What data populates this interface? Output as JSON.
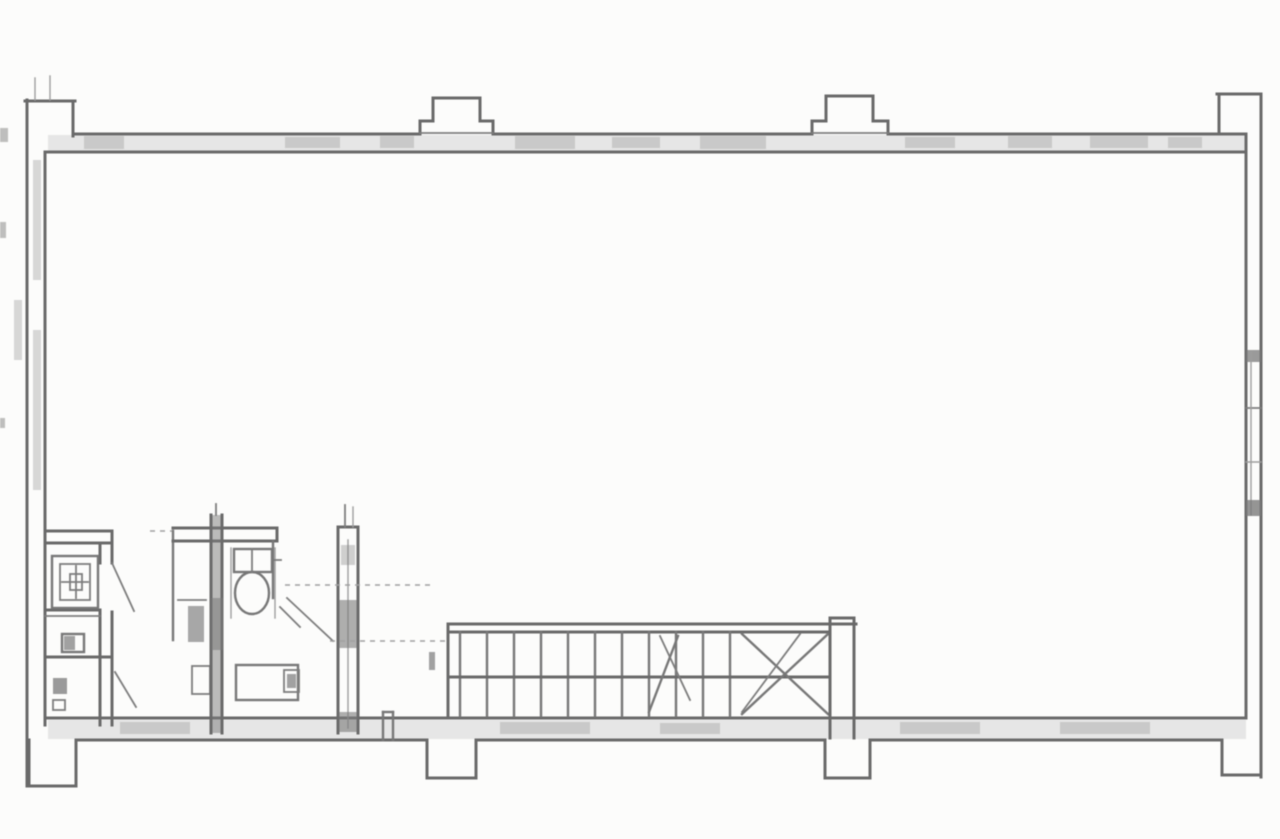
{
  "document": {
    "type": "scanned architectural floor plan",
    "title": "Floor plan scan (no visible text labels)",
    "description": "Black-and-white scanned floor plan of a large open rectangular floor. Exterior walls have pilaster projections on the top and bottom edges and at all four corners. A service/bathroom block with shower tray, wash basin, toilet and a vertical duct sits at the lower left. A straight staircase with winder treads at its right end runs along the lower middle. A window opening is indicated in the right wall.",
    "colors": {
      "paper": "#fcfcfb",
      "line": "#6a6a6a",
      "wall_fill": "#c7c7c7",
      "faint_line": "#a0a0a0"
    }
  },
  "elements": {
    "outer_wall": {
      "label": "exterior wall outline with hatched poche"
    },
    "pilaster_top_left": {
      "label": "corner pilaster, top left"
    },
    "pilaster_top_1": {
      "label": "wall pilaster, top edge (left of center)"
    },
    "pilaster_top_2": {
      "label": "wall pilaster, top edge (right of center)"
    },
    "pilaster_top_right": {
      "label": "corner pilaster, top right"
    },
    "pilaster_bottom_left": {
      "label": "corner pilaster, bottom left"
    },
    "pilaster_bottom_1": {
      "label": "wall pilaster, bottom edge (left of center)"
    },
    "pilaster_bottom_2": {
      "label": "wall pilaster, bottom edge (right of center)"
    },
    "pilaster_bottom_right": {
      "label": "corner pilaster, bottom right"
    },
    "window_right_wall": {
      "label": "window opening in right wall"
    },
    "service_block": {
      "label": "bathroom / service rooms block"
    },
    "shower_tray": {
      "label": "shower tray with drain"
    },
    "wash_basin": {
      "label": "wash basin fixture"
    },
    "toilet": {
      "label": "toilet with cistern"
    },
    "counter_fixture": {
      "label": "lower counter fixture with basin"
    },
    "duct": {
      "label": "vertical service duct / chimney"
    },
    "door_swings": {
      "label": "door swing lines"
    },
    "stairs": {
      "label": "straight staircase with winder treads",
      "riser_count": 11,
      "has_center_rail_line": true,
      "winder_diagonals": true
    },
    "dashed_guides": {
      "label": "faint dashed construction lines"
    },
    "scan_artifacts": {
      "label": "scanner edge specks and smudges"
    }
  }
}
